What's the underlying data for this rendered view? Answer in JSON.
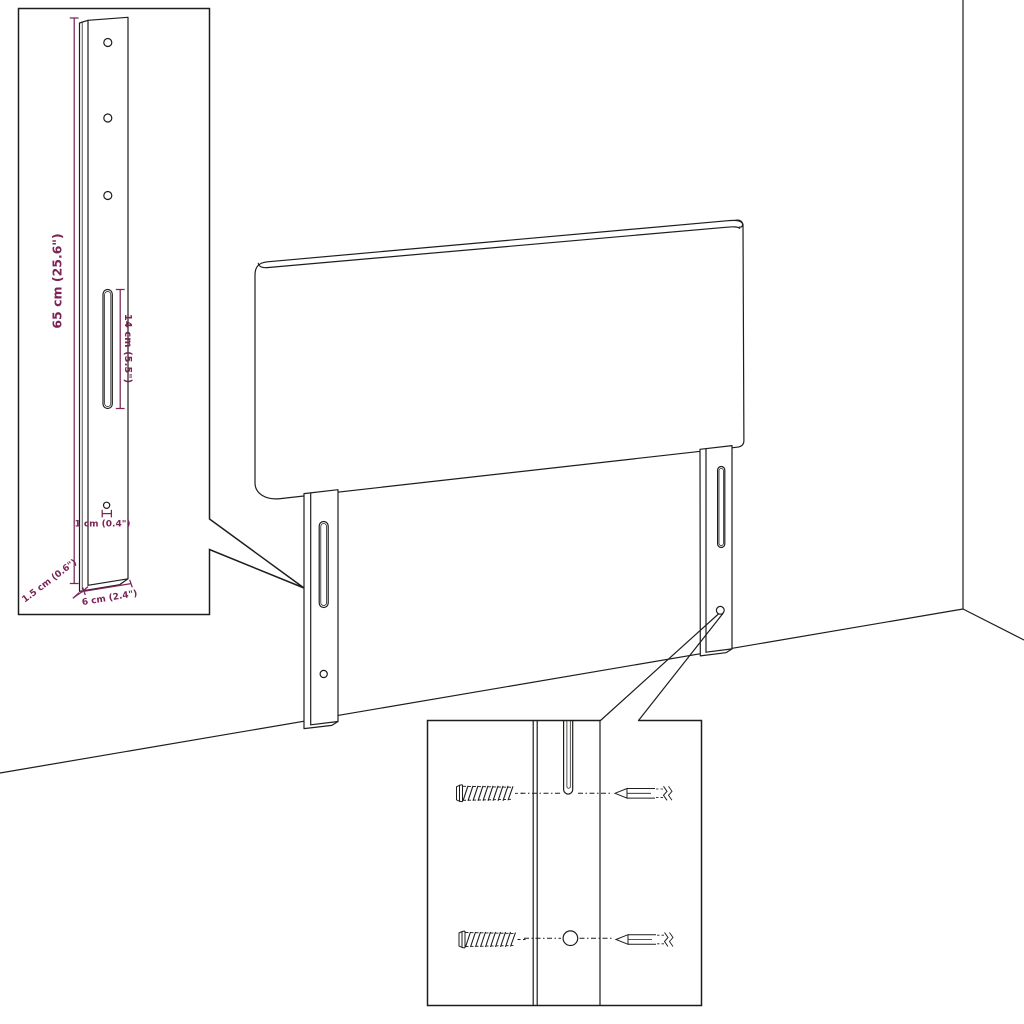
{
  "colors": {
    "line": "#1d1d1b",
    "dimension_text": "#7b2456",
    "background": "#ffffff"
  },
  "leg_detail_inset": {
    "height_label": "65 cm (25.6\")",
    "slot_label": "14 cm (5.5\")",
    "hole_label": "1 cm (0.4\")",
    "depth_label": "1.5 cm (0.6\")",
    "width_label": "6 cm (2.4\")"
  },
  "hardware_detail_inset": {
    "icons": [
      "screw-icon",
      "wall-plug-icon"
    ]
  }
}
